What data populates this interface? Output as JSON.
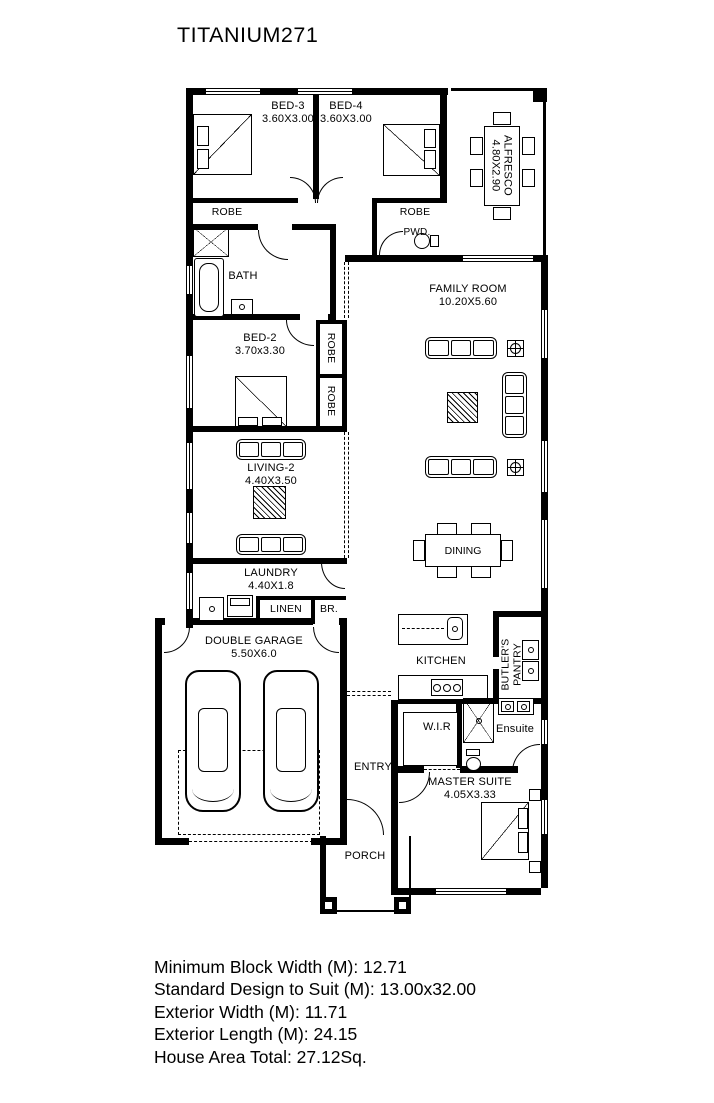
{
  "title": "TITANIUM271",
  "rooms": {
    "bed3": {
      "name": "BED-3",
      "dims": "3.60X3.00"
    },
    "bed4": {
      "name": "BED-4",
      "dims": "3.60X3.00"
    },
    "alfresco": {
      "name": "ALFRESCO",
      "dims": "4.80X2.90"
    },
    "robe3": "ROBE",
    "robe4": "ROBE",
    "pwd": "PWD.",
    "bath": "BATH",
    "family": {
      "name": "FAMILY ROOM",
      "dims": "10.20X5.60"
    },
    "bed2": {
      "name": "BED-2",
      "dims": "3.70x3.30"
    },
    "robe_a": "ROBE",
    "robe_b": "ROBE",
    "living2": {
      "name": "LIVING-2",
      "dims": "4.40X3.50"
    },
    "laundry": {
      "name": "LAUNDRY",
      "dims": "4.40X1.8"
    },
    "linen": "LINEN",
    "br": "BR.",
    "garage": {
      "name": "DOUBLE GARAGE",
      "dims": "5.50X6.0"
    },
    "dining": "DINING",
    "kitchen": "KITCHEN",
    "butlers": {
      "line1": "BUTLER'S",
      "line2": "PANTRY"
    },
    "wir": "W.I.R",
    "ensuite": "Ensuite",
    "entry": "ENTRY",
    "master": {
      "name": "MASTER SUITE",
      "dims": "4.05X3.33"
    },
    "porch": "PORCH"
  },
  "specs": {
    "lines": [
      "Minimum Block Width (M): 12.71",
      "Standard Design to Suit (M): 13.00x32.00",
      "Exterior Width (M): 11.71",
      "Exterior Length (M): 24.15",
      "House Area Total: 27.12Sq."
    ]
  },
  "colors": {
    "ink": "#000000",
    "paper": "#ffffff"
  }
}
